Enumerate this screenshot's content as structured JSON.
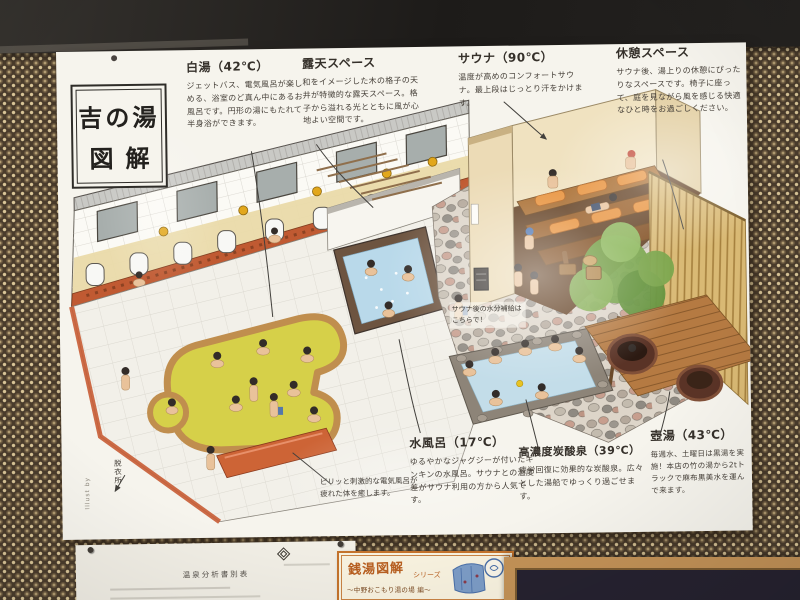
{
  "poster": {
    "title_line1": "吉の湯",
    "title_line2": "図解",
    "annotations": [
      {
        "id": "shirayu",
        "title": "白湯（42℃）",
        "body": "ジェットバス、電気風呂が楽しめる、浴室のど真ん中にあるお風呂です。円形の湯にもたれて半身浴ができます。"
      },
      {
        "id": "roten",
        "title": "露天スペース",
        "body": "和をイメージした木の格子の天井が特徴的な露天スペース。格子から溢れる光とともに風が心地よい空間です。"
      },
      {
        "id": "sauna",
        "title": "サウナ（90℃）",
        "body": "温度が高めのコンフォートサウナ。最上段はじっとり汗をかけます。"
      },
      {
        "id": "kyukei",
        "title": "休憩スペース",
        "body": "サウナ後、湯上りの休憩にぴったりなスペースです。椅子に座って、庭を見ながら風を感じる快適なひと時をお過ごしください。"
      },
      {
        "id": "mizuburo",
        "title": "水風呂（17℃）",
        "body": "ゆるやかなジャグジーが付いたキンキンの水風呂。サウナとの温度差がサウナ利用の方から人気です。"
      },
      {
        "id": "tansan",
        "title": "高濃度炭酸泉（39℃）",
        "body": "疲労回復に効果的な炭酸泉。広々とした湯船でゆっくり過ごせます。"
      },
      {
        "id": "tsuboyu",
        "title": "壺湯（43℃）",
        "body": "毎週水、土曜日は黒湯を実施！本店の竹の湯から2tトラックで麻布黒美水を運んで来ます。"
      }
    ],
    "notes": {
      "denki": "ピリッと刺激的な電気風呂が疲れた体を癒します。",
      "suibun": "サウナ後の水分補給はこちらで！",
      "datsuijo": "脱衣所",
      "credit": "Illust by"
    }
  },
  "surroundings": {
    "analysis_sheet_title": "温泉分析書別表",
    "mini_poster": {
      "line1": "銭湯図解",
      "line2": "シリーズ",
      "line3": "〜中野おこもり湯の場 編〜"
    }
  },
  "colors": {
    "poster_bg": "#f6f4ed",
    "wall_brown": "#4a3c2c",
    "wall_dot": "#d9c598",
    "bath_yellow": "#d6d049",
    "water_blue": "#b9d9ea",
    "accent_orange": "#c05a32",
    "sauna_cushion": "#e8913a",
    "frame_wood": "#c39257"
  }
}
